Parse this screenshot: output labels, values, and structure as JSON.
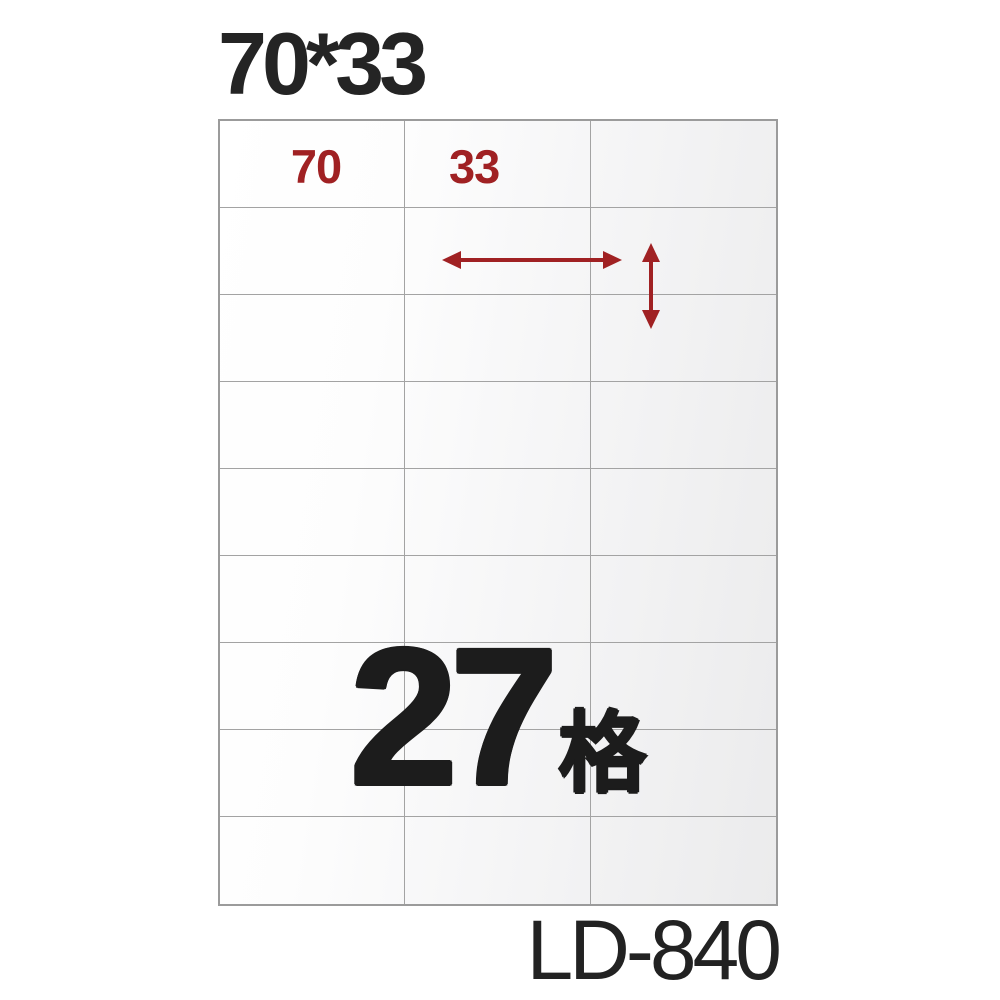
{
  "title": {
    "text": "70*33"
  },
  "sheet": {
    "columns": 3,
    "rows": 9,
    "cell_count": 27,
    "label_width_mm": "70",
    "label_height_mm": "33"
  },
  "dimensions": {
    "width_label": "70",
    "height_label": "33"
  },
  "count": {
    "number": "27",
    "unit": "格"
  },
  "model": {
    "text": "LD-840"
  },
  "colors": {
    "accent_red": "#a02123",
    "ink": "#1f1f1f",
    "grid_line": "#a3a3a3",
    "sheet_fill_start": "#ffffff",
    "sheet_fill_end": "#ebebec",
    "background": "#ffffff"
  }
}
